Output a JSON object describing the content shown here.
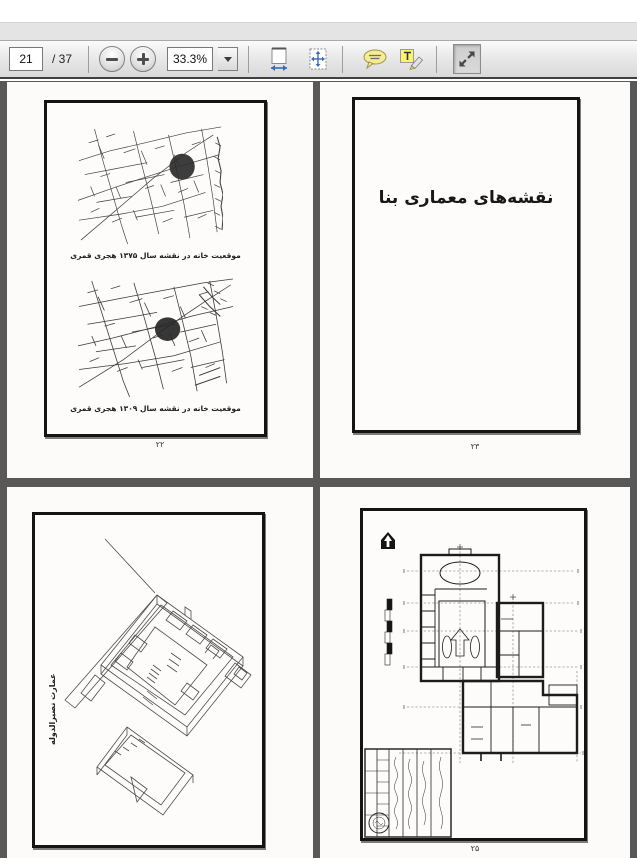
{
  "toolbar": {
    "page_number": "21",
    "page_total": "/ 37",
    "zoom_level": "33.3%",
    "icons": [
      "zoom-out-icon",
      "zoom-in-icon",
      "zoom-dropdown-icon",
      "fit-width-icon",
      "fit-page-icon",
      "comment-icon",
      "highlight-text-icon",
      "fullscreen-icon"
    ]
  },
  "colors": {
    "doc_background": "#585858",
    "toolbar_bg": "#e9e9e9",
    "page_bg": "#fcfbf9",
    "comment_yellow": "#f6ee8e",
    "highlight_yellow": "#f9f370",
    "fit_arrow_blue": "#3a6cb4",
    "frame_black": "#141414"
  },
  "spread_pages": {
    "map_page": {
      "caption_top": "موقعیت خانه در نقشه سال ۱۳۷۵ هجری قمری",
      "caption_bottom": "موقعیت خانه در نقشه سال ۱۳۰۹ هجری قمری",
      "page_number": "۲۲"
    },
    "title_page": {
      "title": "نقشه‌های معماری بنا",
      "page_number": "۲۳"
    },
    "axonometric_page": {
      "side_label": "عمارت نصیرالدوله"
    },
    "plan_page": {
      "page_number": "۲۵",
      "icons": [
        "north-arrow-icon",
        "scale-bar"
      ]
    }
  }
}
